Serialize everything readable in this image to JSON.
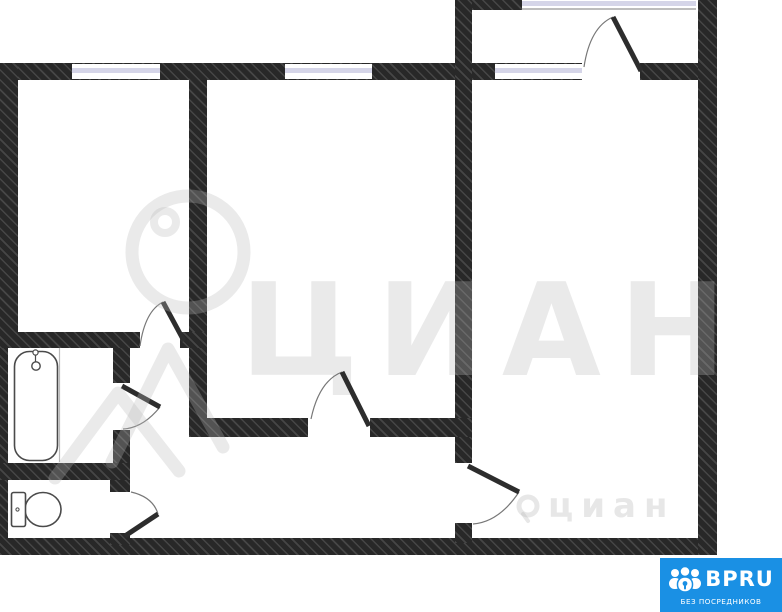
{
  "colors": {
    "wall": "#282828",
    "window_sash": "#d5d5e8",
    "background": "#ffffff",
    "logo_blue": "#1a90e4",
    "watermark_gray": "#ededed"
  },
  "watermarks": {
    "big_text": "ЦИАН",
    "small_text": "циан"
  },
  "logo": {
    "brand": "BPRU",
    "tagline": "БЕЗ ПОСРЕДНИКОВ"
  }
}
